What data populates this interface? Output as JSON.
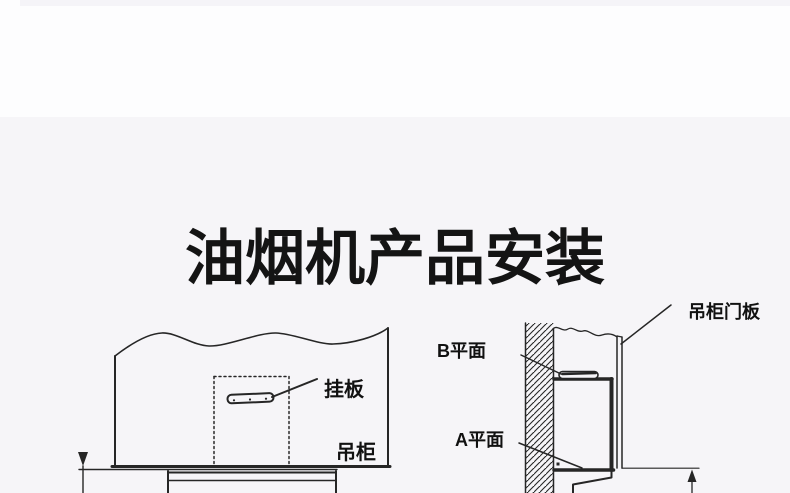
{
  "page": {
    "title": "油烟机产品安装",
    "colors": {
      "page_background": "#fdfdfe",
      "section_background": "#f6f5f8",
      "line_color": "#262626",
      "title_color": "#141414"
    }
  },
  "left_diagram": {
    "labels": {
      "hang_plate": "挂板",
      "cabinet": "吊柜"
    }
  },
  "right_diagram": {
    "labels": {
      "b_plane": "B平面",
      "a_plane": "A平面",
      "cabinet_door_panel": "吊柜门板"
    }
  }
}
